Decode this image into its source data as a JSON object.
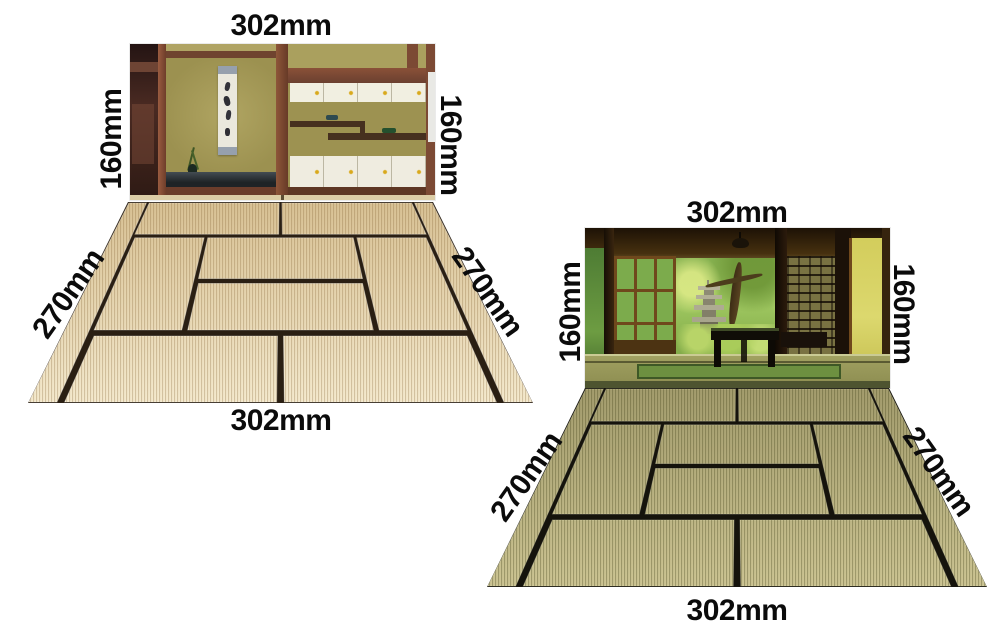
{
  "figures": [
    {
      "name": "cream-tatami-room-scene",
      "labels": {
        "top": "302mm",
        "left": "160mm",
        "right": "160mm",
        "diag_left": "270mm",
        "diag_right": "270mm",
        "bottom": "302mm"
      }
    },
    {
      "name": "green-tatami-garden-scene",
      "labels": {
        "top": "302mm",
        "left": "160mm",
        "right": "160mm",
        "diag_left": "270mm",
        "diag_right": "270mm",
        "bottom": "302mm"
      }
    }
  ],
  "colors": {
    "background": "#ffffff",
    "label_text": "#0b0b0b",
    "mat_cream_far": "#d8c194",
    "mat_cream_near": "#f4e9cd",
    "mat_cream_stripe": "rgba(125,95,45,0.28)",
    "seam_cream": "#2a1f13",
    "mat_green_far": "#a39c6d",
    "mat_green_near": "#ccc493",
    "mat_green_stripe": "rgba(55,55,18,0.30)",
    "seam_green": "#15130c"
  }
}
